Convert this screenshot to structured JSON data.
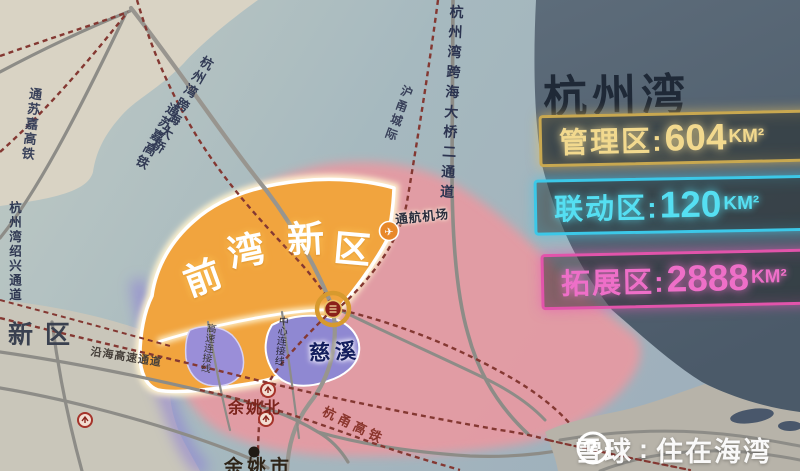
{
  "title": "杭州湾",
  "legend": {
    "items": [
      {
        "name": "管理区",
        "label": "管理区:",
        "value": "604",
        "unit": "KM²",
        "color": "#f2d98e"
      },
      {
        "name": "联动区",
        "label": "联动区:",
        "value": "120",
        "unit": "KM²",
        "color": "#55dff2"
      },
      {
        "name": "拓展区",
        "label": "拓展区:",
        "value": "2888",
        "unit": "KM²",
        "color": "#ee6fc8"
      }
    ]
  },
  "map": {
    "region": {
      "name": "前湾新区"
    },
    "places": {
      "cixi": "慈溪",
      "yuyao_north": "余姚北",
      "yuyao_city": "余姚市",
      "xinqu": "新区",
      "airport": "通航机场"
    },
    "routes": {
      "bridge": "杭州湾跨海大桥",
      "bridge2": "杭州湾跨海大桥二通道",
      "tongsujia": "通苏嘉高铁",
      "tongsujia_west": "通苏嘉高铁",
      "huyong_intercity": "沪甬城际",
      "shaoxing_passage": "杭州湾绍兴通道",
      "hangyong_hsr": "杭甬高铁",
      "coastal_expwy": "沿海高速通道",
      "expwy_connector": "高速连接线",
      "center_connector": "中心连接线"
    }
  },
  "watermark": {
    "brand": "雪球",
    "separator": ":",
    "name": "住在海湾"
  },
  "colors": {
    "water": "#a9bac1",
    "land": "#d9d3c4",
    "panel": "#566573",
    "zone_pink": "#e79aa2",
    "zone_orange": "#f1a43e",
    "urban_purple": "#938cd6",
    "violet_edge": "#8d7fd6",
    "railway": "#843832",
    "road": "#8d8c87",
    "legend_gold": "#f2d98e",
    "legend_cyan": "#55dff2",
    "legend_magenta": "#ee6fc8"
  }
}
